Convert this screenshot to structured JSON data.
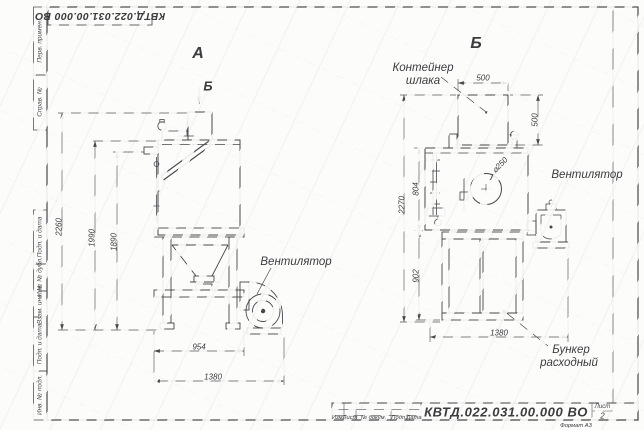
{
  "page": {
    "corner_stamp": "КВТД.022.031.00.000  ВО",
    "format_note": "Формат А3"
  },
  "margin_cells": [
    {
      "label": "Перв. примен."
    },
    {
      "label": "Справ. №"
    },
    {
      "label": "Подп. и дата"
    },
    {
      "label": "Инв. № дубл."
    },
    {
      "label": "Взам. инв. №"
    },
    {
      "label": "Подп. и дата"
    },
    {
      "label": "Инв. № подл."
    }
  ],
  "front_view": {
    "view_label_a": "А",
    "view_label_b": "Б",
    "fan_label": "Вентилятор",
    "dim_total_height": "2260",
    "dim_body_height": "1990",
    "dim_inlet_height": "1890",
    "dim_body_width": "954",
    "dim_total_width": "1380"
  },
  "side_view": {
    "view_label": "Б",
    "container_label_line1": "Контейнер",
    "container_label_line2": "шлака",
    "fan_label": "Вентилятор",
    "bunker_label_line1": "Бункер",
    "bunker_label_line2": "расходный",
    "dim_container_width": "500",
    "dim_container_height": "500",
    "dim_body_height": "804",
    "dim_frame_height": "902",
    "dim_total_height": "2270",
    "dim_total_depth": "1380",
    "dim_opening_diameter": "⌀250"
  },
  "title_block": {
    "doc_number": "КВТД.022.031.00.000  ВО",
    "columns": [
      "Изм.",
      "Лист",
      "№ докум.",
      "Подп.",
      "Дата"
    ],
    "sheet_label": "Лист",
    "sheet_number": "2"
  }
}
